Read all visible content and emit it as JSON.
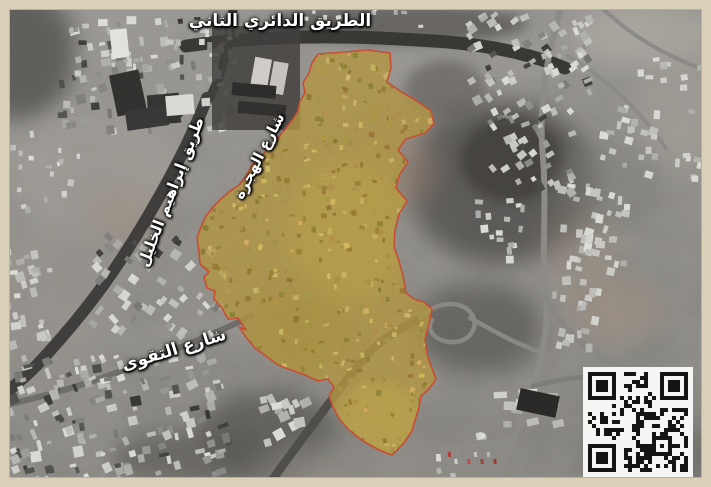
{
  "figure": {
    "kind": "satellite-map",
    "frame_border_color": "#d9d0b7"
  },
  "labels": {
    "ring_road": "الطريق الدائري الثاني",
    "ibrahim_al_khalil": "طريق إبراهيم الخليل",
    "al_hijrah": "شارع الهجرة",
    "al_taqwa": "شارع التقوى"
  },
  "highlight_region": {
    "fill": "#b7993d",
    "fill_opacity": 0.8,
    "stroke": "#cd4a2e",
    "stroke_width": 1.6,
    "points": [
      [
        318,
        54
      ],
      [
        344,
        52
      ],
      [
        368,
        50
      ],
      [
        390,
        53
      ],
      [
        391,
        68
      ],
      [
        387,
        82
      ],
      [
        400,
        91
      ],
      [
        417,
        101
      ],
      [
        431,
        111
      ],
      [
        434,
        124
      ],
      [
        425,
        133
      ],
      [
        406,
        139
      ],
      [
        398,
        150
      ],
      [
        408,
        162
      ],
      [
        400,
        174
      ],
      [
        396,
        188
      ],
      [
        407,
        201
      ],
      [
        399,
        214
      ],
      [
        395,
        230
      ],
      [
        394,
        247
      ],
      [
        399,
        261
      ],
      [
        403,
        276
      ],
      [
        406,
        293
      ],
      [
        414,
        299
      ],
      [
        424,
        302
      ],
      [
        432,
        309
      ],
      [
        429,
        324
      ],
      [
        425,
        339
      ],
      [
        427,
        354
      ],
      [
        431,
        366
      ],
      [
        436,
        379
      ],
      [
        429,
        389
      ],
      [
        421,
        396
      ],
      [
        419,
        408
      ],
      [
        415,
        420
      ],
      [
        412,
        431
      ],
      [
        403,
        444
      ],
      [
        392,
        455
      ],
      [
        379,
        450
      ],
      [
        363,
        441
      ],
      [
        350,
        431
      ],
      [
        340,
        420
      ],
      [
        333,
        407
      ],
      [
        329,
        396
      ],
      [
        334,
        387
      ],
      [
        328,
        379
      ],
      [
        318,
        381
      ],
      [
        305,
        375
      ],
      [
        291,
        370
      ],
      [
        278,
        365
      ],
      [
        266,
        356
      ],
      [
        255,
        348
      ],
      [
        246,
        337
      ],
      [
        239,
        327
      ],
      [
        246,
        330
      ],
      [
        238,
        318
      ],
      [
        228,
        319
      ],
      [
        222,
        308
      ],
      [
        214,
        299
      ],
      [
        215,
        291
      ],
      [
        207,
        288
      ],
      [
        204,
        277
      ],
      [
        209,
        272
      ],
      [
        200,
        264
      ],
      [
        199,
        251
      ],
      [
        197,
        238
      ],
      [
        201,
        227
      ],
      [
        206,
        216
      ],
      [
        213,
        207
      ],
      [
        221,
        199
      ],
      [
        230,
        191
      ],
      [
        239,
        185
      ],
      [
        247,
        175
      ],
      [
        252,
        165
      ],
      [
        261,
        157
      ],
      [
        268,
        149
      ],
      [
        276,
        142
      ],
      [
        281,
        134
      ],
      [
        287,
        127
      ],
      [
        293,
        119
      ],
      [
        298,
        111
      ],
      [
        300,
        101
      ],
      [
        305,
        93
      ],
      [
        303,
        83
      ],
      [
        309,
        73
      ],
      [
        312,
        63
      ]
    ]
  },
  "qr_code": {
    "foreground": "#141414",
    "background": "#f5f5f3"
  }
}
